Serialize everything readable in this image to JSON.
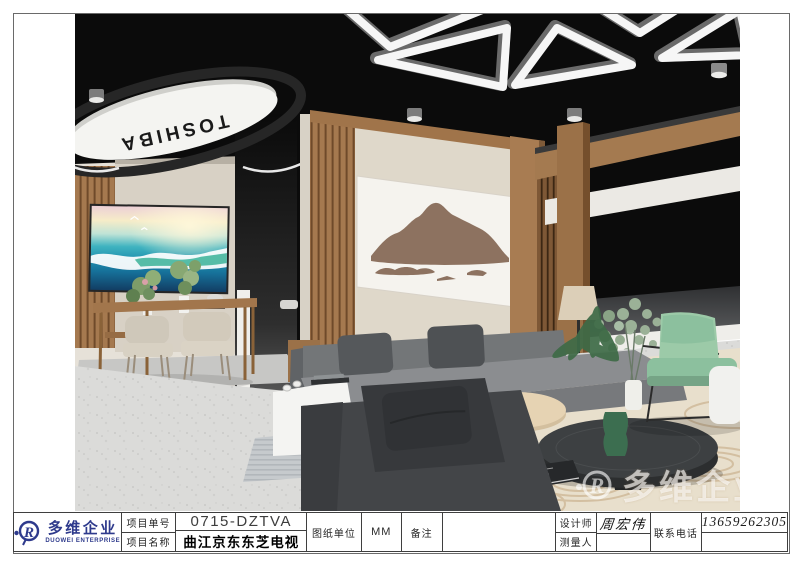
{
  "sheet": {
    "type": "interior-render-drawing",
    "palette": {
      "ceiling_black": "#0b0b0b",
      "wood": "#a57c52",
      "wall_beige": "#ded7c9",
      "sofa_gray": "#85878a",
      "chaise_charcoal": "#434548",
      "armchair_green": "#8fc0a0",
      "rug_cream": "#e8dfcc",
      "floor_terrazzo": "#dbdbd9",
      "logo_blue": "#2e3a8c"
    }
  },
  "render": {
    "sign": {
      "brand": "TOSHIBA"
    },
    "watermark": {
      "text": "多维企业",
      "mark": "duowei-monogram"
    }
  },
  "title_block": {
    "logo": {
      "name": "多维企业",
      "subtitle": "DUOWEI ENTERPRISE",
      "mark": "duowei-monogram"
    },
    "fields": {
      "project_no_label": "项目单号",
      "project_no": "0715-DZTVA",
      "project_name_label": "项目名称",
      "project_name": "曲江京东东芝电视",
      "unit_label": "图纸单位",
      "unit": "MM",
      "remark_label": "备注",
      "remark": "",
      "designer_label": "设计师",
      "designer": "周宏伟",
      "surveyor_label": "测量人",
      "surveyor": "",
      "phone_label": "联系电话",
      "phone": "13659262305"
    }
  }
}
